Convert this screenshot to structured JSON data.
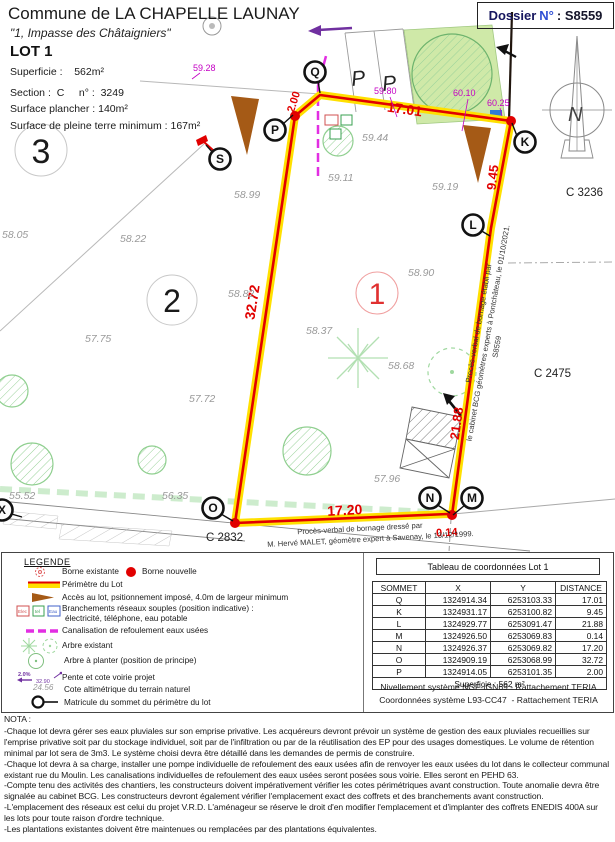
{
  "header": {
    "commune": "Commune de LA CHAPELLE LAUNAY",
    "address": "\"1, Impasse des Châtaigniers\"",
    "lot_title": "LOT 1",
    "superficie": "Superficie :    562m²",
    "section": "Section :  C     n° :  3249",
    "surface_plancher": "Surface plancher : 140m²",
    "pleine_terre": "Surface de pleine terre minimum : 167m²"
  },
  "dossier": {
    "word": "Dossier",
    "no": "N°",
    "value": ": S8559"
  },
  "plan": {
    "sommets": {
      "q": "Q",
      "p": "P",
      "s": "S",
      "k": "K",
      "l": "L",
      "m": "M",
      "n": "N",
      "o": "O",
      "x": "X"
    },
    "lot_numbers": {
      "lot1": "1",
      "lot2": "2",
      "lot3": "3"
    },
    "measures": {
      "pq": "2.00",
      "qk": "17.01",
      "kl": "9.45",
      "lm": "21.88",
      "mn": "0.14",
      "no": "17.20",
      "op": "32.72"
    },
    "project_elevations": {
      "e1": "59.28",
      "e2": "59.80",
      "e3": "60.10",
      "e4": "60.25"
    },
    "natural_elevations": [
      "59.44",
      "59.11",
      "59.19",
      "58.99",
      "58.82",
      "58.90",
      "58.37",
      "58.68",
      "57.72",
      "58.05",
      "58.22",
      "57.75",
      "55.52",
      "56.35",
      "57.96"
    ],
    "parcels": {
      "c3236": "C 3236",
      "c2475": "C 2475",
      "c2832": "C 2832"
    },
    "parking_label": "P",
    "compass": "N",
    "pv_right": [
      "Procès-verbal de bornage établi par",
      "le cabinet BCG géomètres experts à Pontchâteau, le 01/10/2021.",
      "S8559"
    ],
    "pv_bottom": [
      "Procès-verbal de bornage dressé par",
      "M. Hervé MALET, géomètre expert à Savenay, le 13/12/1999."
    ]
  },
  "legend": {
    "title": "LEGENDE",
    "borne_existante": "Borne existante",
    "borne_nouvelle": "Borne nouvelle",
    "perimetre": "Périmètre du Lot",
    "acces": "Accès au lot, psitionnement imposé, 4.0m de largeur minimum",
    "branchements_line1": "Branchements réseaux souples (position indicative) :",
    "branchements_line2": "électricité, téléphone, eau potable",
    "branchement_boxes": [
      "Elec",
      "tel",
      "Eau"
    ],
    "canalisation": "Canalisation de refoulement eaux usées",
    "arbre_existant": "Arbre existant",
    "arbre_planter": "Arbre à planter (position de principe)",
    "pente_pct": "2.0%",
    "pente_cote": "32.90",
    "pente_label": "Pente et cote voirie projet",
    "cote_value": "24.56",
    "cote_label": "Cote altimétrique du terrain naturel",
    "matricule_label": "Matricule du sommet du périmètre du lot"
  },
  "table": {
    "title": "Tableau de coordonnées Lot 1",
    "headers": [
      "SOMMET",
      "X",
      "Y",
      "DISTANCE"
    ],
    "rows": [
      {
        "s": "Q",
        "x": "1324914.34",
        "y": "6253103.33",
        "d": "17.01"
      },
      {
        "s": "K",
        "x": "1324931.17",
        "y": "6253100.82",
        "d": "9.45"
      },
      {
        "s": "L",
        "x": "1324929.77",
        "y": "6253091.47",
        "d": "21.88"
      },
      {
        "s": "M",
        "x": "1324926.50",
        "y": "6253069.83",
        "d": "0.14"
      },
      {
        "s": "N",
        "x": "1324926.37",
        "y": "6253069.82",
        "d": "17.20"
      },
      {
        "s": "O",
        "x": "1324909.19",
        "y": "6253068.99",
        "d": "32.72"
      },
      {
        "s": "P",
        "x": "1324914.05",
        "y": "6253101.35",
        "d": "2.00"
      }
    ],
    "footer": "Superficie : 562 m²",
    "note1": "Nivellement système NGF-IGN69 - Rattachement TERIA",
    "note2": "Coordonnées système L93-CC47  - Rattachement TERIA"
  },
  "nota": {
    "title": "NOTA :",
    "items": [
      "-Chaque lot devra gérer ses eaux pluviales sur son emprise privative. Les acquéreurs devront prévoir un système de gestion des eaux pluviales recueillies sur l'emprise privative soit par du stockage individuel, soit par de l'infiltration ou par de la réutilisation des EP pour des usages domestiques. Le volume de rétention minimal par lot sera de 3m3. Le système choisi devra être détaillé dans les demandes de permis de construire.",
      "-Chaque lot devra à sa charge, installer une pompe individuelle de refoulement des eaux usées afin de renvoyer les eaux usées du lot dans le collecteur communal existant rue du Moulin. Les canalisations individuelles de refoulement des eaux usées seront posées sous voirie. Elles seront en PEHD 63.",
      "-Compte tenu des activités des chantiers, les constructeurs doivent impérativement vérifier les cotes périmétriques avant construction. Toute anomalie devra être signalée au cabinet BCG. Les constructeurs devront également vérifier l'emplacement exact des coffrets et des branchements avant construction.",
      "-L'emplacement des réseaux est celui du projet V.R.D. L'aménageur se réserve le droit d'en modifier l'emplacement et d'implanter des coffrets ENEDIS 400A sur les lots pour toute raison d'ordre technique.",
      "-Les plantations existantes doivent être maintenues ou remplacées par des plantations équivalentes."
    ]
  },
  "colors": {
    "boundary_red": "#e10000",
    "boundary_yellow": "#ffe000",
    "elevation_magenta": "#c400c4",
    "canalisation_magenta": "#e22ee2",
    "access_brown": "#a55a16",
    "vegetation_green": "#8fcf8f",
    "water_blue": "#2e7bd6",
    "arrow_purple": "#7030a0",
    "dossier_blue": "#2f4fd4"
  }
}
